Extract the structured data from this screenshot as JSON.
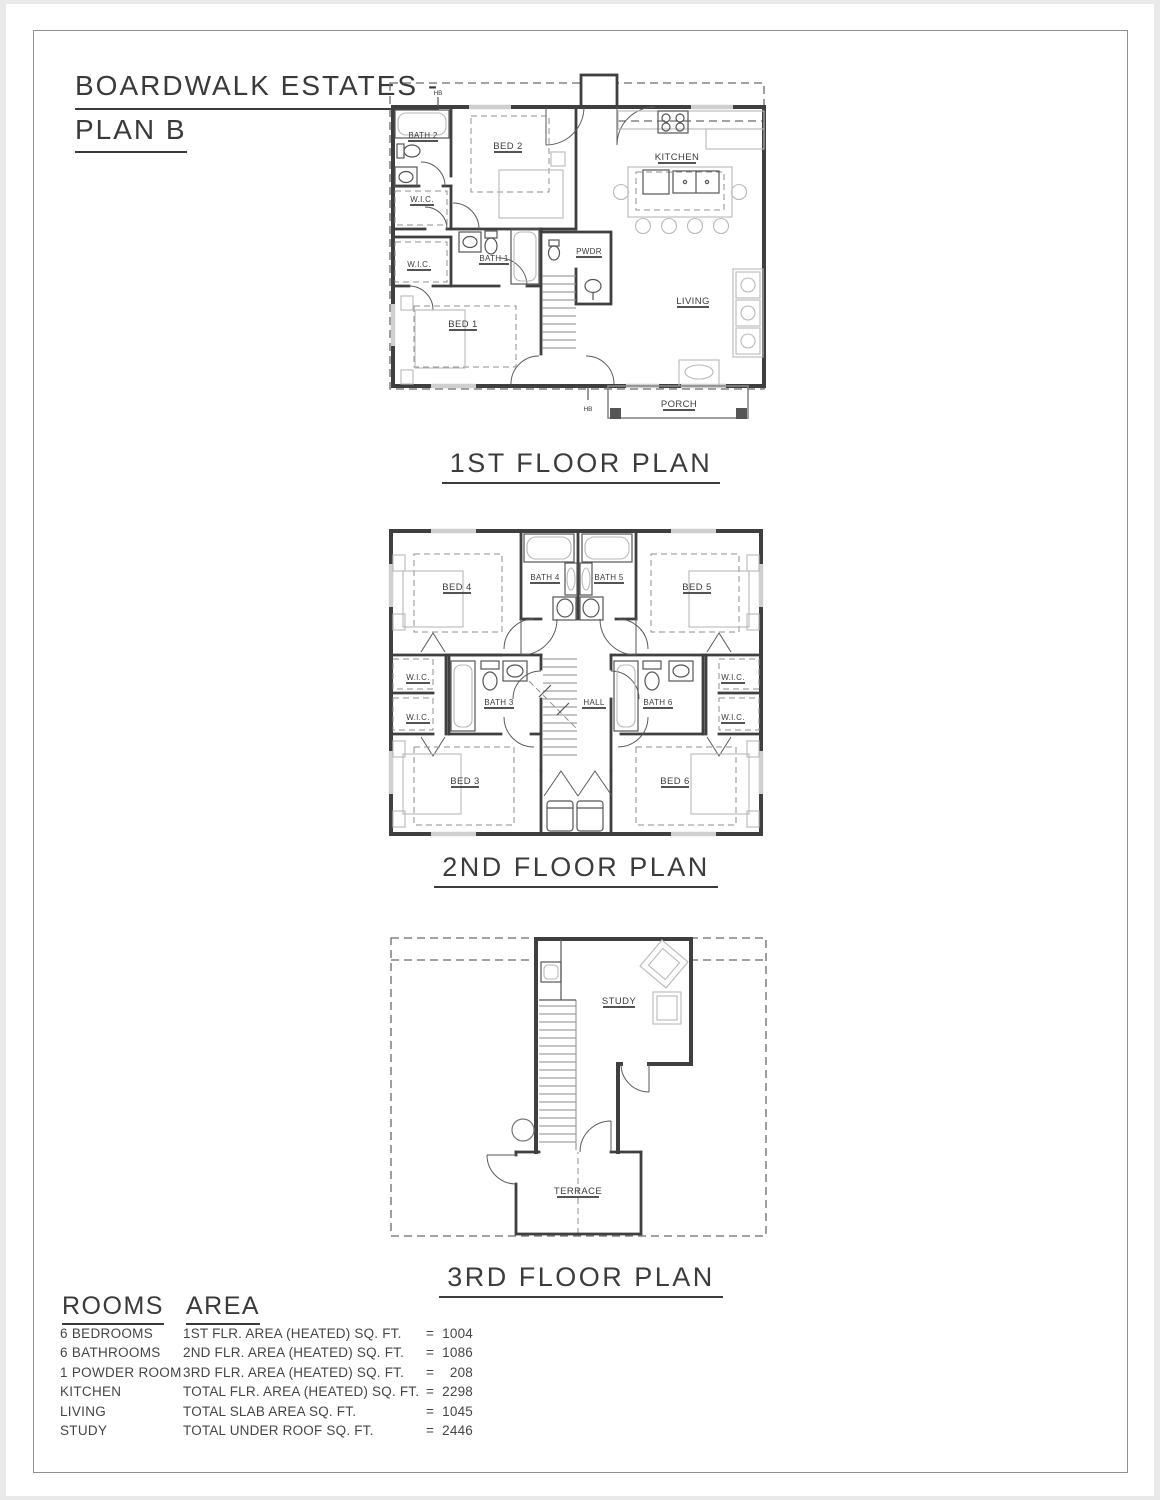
{
  "title": {
    "line1": "BOARDWALK ESTATES -",
    "line2": "PLAN B"
  },
  "floor1": {
    "caption": "1ST FLOOR PLAN",
    "labels": {
      "hb_top": "HB",
      "bath2": "BATH 2",
      "bed2": "BED 2",
      "kitchen": "KITCHEN",
      "wic_a": "W.I.C.",
      "wic_b": "W.I.C.",
      "bath1": "BATH 1",
      "pwdr": "PWDR",
      "bed1": "BED 1",
      "living": "LIVING",
      "porch": "PORCH",
      "hb_bottom": "HB"
    }
  },
  "floor2": {
    "caption": "2ND FLOOR PLAN",
    "labels": {
      "bed4": "BED 4",
      "bath4": "BATH 4",
      "bath5": "BATH 5",
      "bed5": "BED 5",
      "wic_l1": "W.I.C.",
      "wic_l2": "W.I.C.",
      "wic_r1": "W.I.C.",
      "wic_r2": "W.I.C.",
      "bath3": "BATH 3",
      "hall": "HALL",
      "bath6": "BATH 6",
      "bed3": "BED 3",
      "bed6": "BED 6"
    }
  },
  "floor3": {
    "caption": "3RD FLOOR PLAN",
    "labels": {
      "study": "STUDY",
      "terrace": "TERRACE"
    }
  },
  "summary": {
    "rooms_header": "ROOMS",
    "area_header": "AREA",
    "rooms": [
      "6 BEDROOMS",
      "6 BATHROOMS",
      "1 POWDER ROOM",
      "KITCHEN",
      "LIVING",
      "STUDY"
    ],
    "areas": [
      {
        "label": "1ST FLR. AREA (HEATED) SQ. FT.",
        "eq": "=",
        "value": "1004"
      },
      {
        "label": "2ND FLR. AREA (HEATED) SQ. FT.",
        "eq": "=",
        "value": "1086"
      },
      {
        "label": "3RD FLR. AREA (HEATED) SQ. FT.",
        "eq": "=",
        "value": "208"
      },
      {
        "label": "TOTAL FLR. AREA (HEATED) SQ. FT.",
        "eq": "=",
        "value": "2298"
      },
      {
        "label": "TOTAL SLAB AREA SQ. FT.",
        "eq": "=",
        "value": "1045"
      },
      {
        "label": "TOTAL UNDER ROOF SQ. FT.",
        "eq": "=",
        "value": "2446"
      }
    ]
  },
  "colors": {
    "wall": "#3f3f3f",
    "light_line": "#b9b9b9",
    "text": "#3c3c3c",
    "frame": "#8f8f8f"
  }
}
